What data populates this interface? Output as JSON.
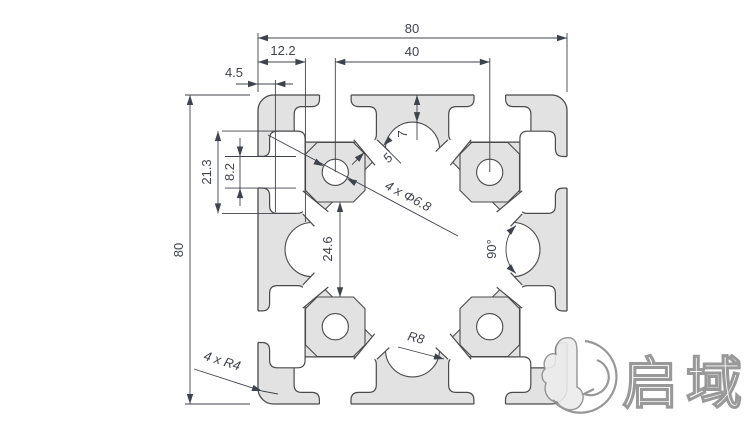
{
  "drawing": {
    "type": "technical-drawing",
    "subject": "80x80 aluminum extrusion profile cross-section",
    "colors": {
      "body_fill": "#e2e2e2",
      "outline": "#4a4a4a",
      "dimension": "#3f434b",
      "background": "#ffffff"
    },
    "dims": {
      "overall_width": "80",
      "hole_pitch": "40",
      "slot_depth": "12.2",
      "lip_thickness": "4.5",
      "cavity_width": "21.3",
      "slot_opening": "8.2",
      "overall_height": "80",
      "boss_gap": "24.6",
      "top_wall": "7",
      "channel_width": "5",
      "holes_note": "4 x Φ6.8",
      "web_angle": "90°",
      "center_fillet": "R8",
      "corner_radius_note": "4 x R4"
    },
    "logo": {
      "brand": "启域"
    }
  }
}
